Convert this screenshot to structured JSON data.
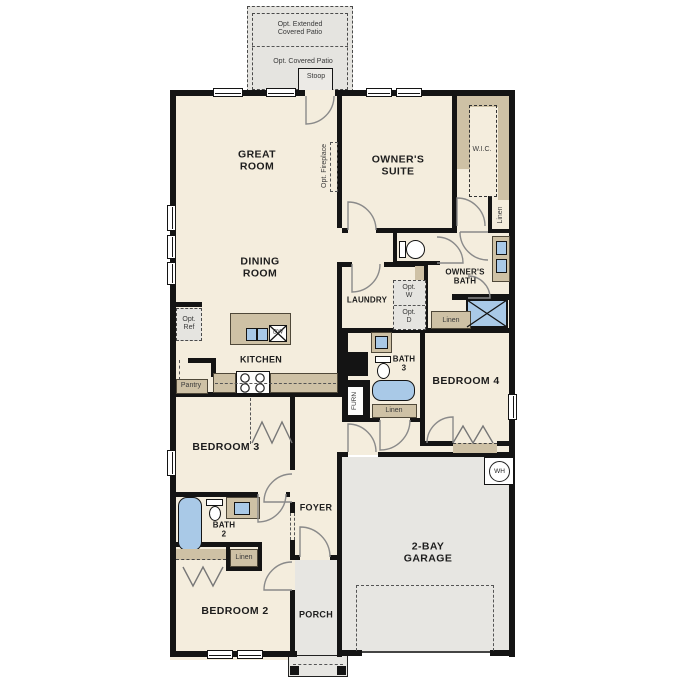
{
  "plan_type": "single-story house floor plan",
  "colors": {
    "room_fill": "#f4eddd",
    "patio_garage_gray": "#e7e6e2",
    "wall_black": "#141414",
    "cabinet_tan": "#cec1a5",
    "fixture_blue": "#a9c9e7",
    "door_swing_gray": "#8a8a8a",
    "background": "#ffffff"
  },
  "labels": {
    "opt_extended_patio": "Opt. Extended\nCovered Patio",
    "opt_covered_patio": "Opt. Covered Patio",
    "stoop": "Stoop",
    "great_room": "GREAT\nROOM",
    "opt_fireplace": "Opt. Fireplace",
    "owners_suite": "OWNER'S\nSUITE",
    "wic": "W.I.C.",
    "linen": "Linen",
    "dining_room": "DINING\nROOM",
    "owners_bath": "OWNER'S\nBATH",
    "laundry": "LAUNDRY",
    "opt_w": "Opt.\nW",
    "opt_d": "Opt.\nD",
    "opt_ref": "Opt.\nRef",
    "kitchen": "KITCHEN",
    "dw": "DW",
    "pantry": "Pantry",
    "bath_3": "BATH\n3",
    "furn": "FURN",
    "bedroom_4": "BEDROOM 4",
    "bedroom_3": "BEDROOM 3",
    "foyer": "FOYER",
    "bath_2": "BATH\n2",
    "bedroom_2": "BEDROOM 2",
    "porch": "PORCH",
    "garage": "2-BAY\nGARAGE",
    "wh": "WH"
  }
}
